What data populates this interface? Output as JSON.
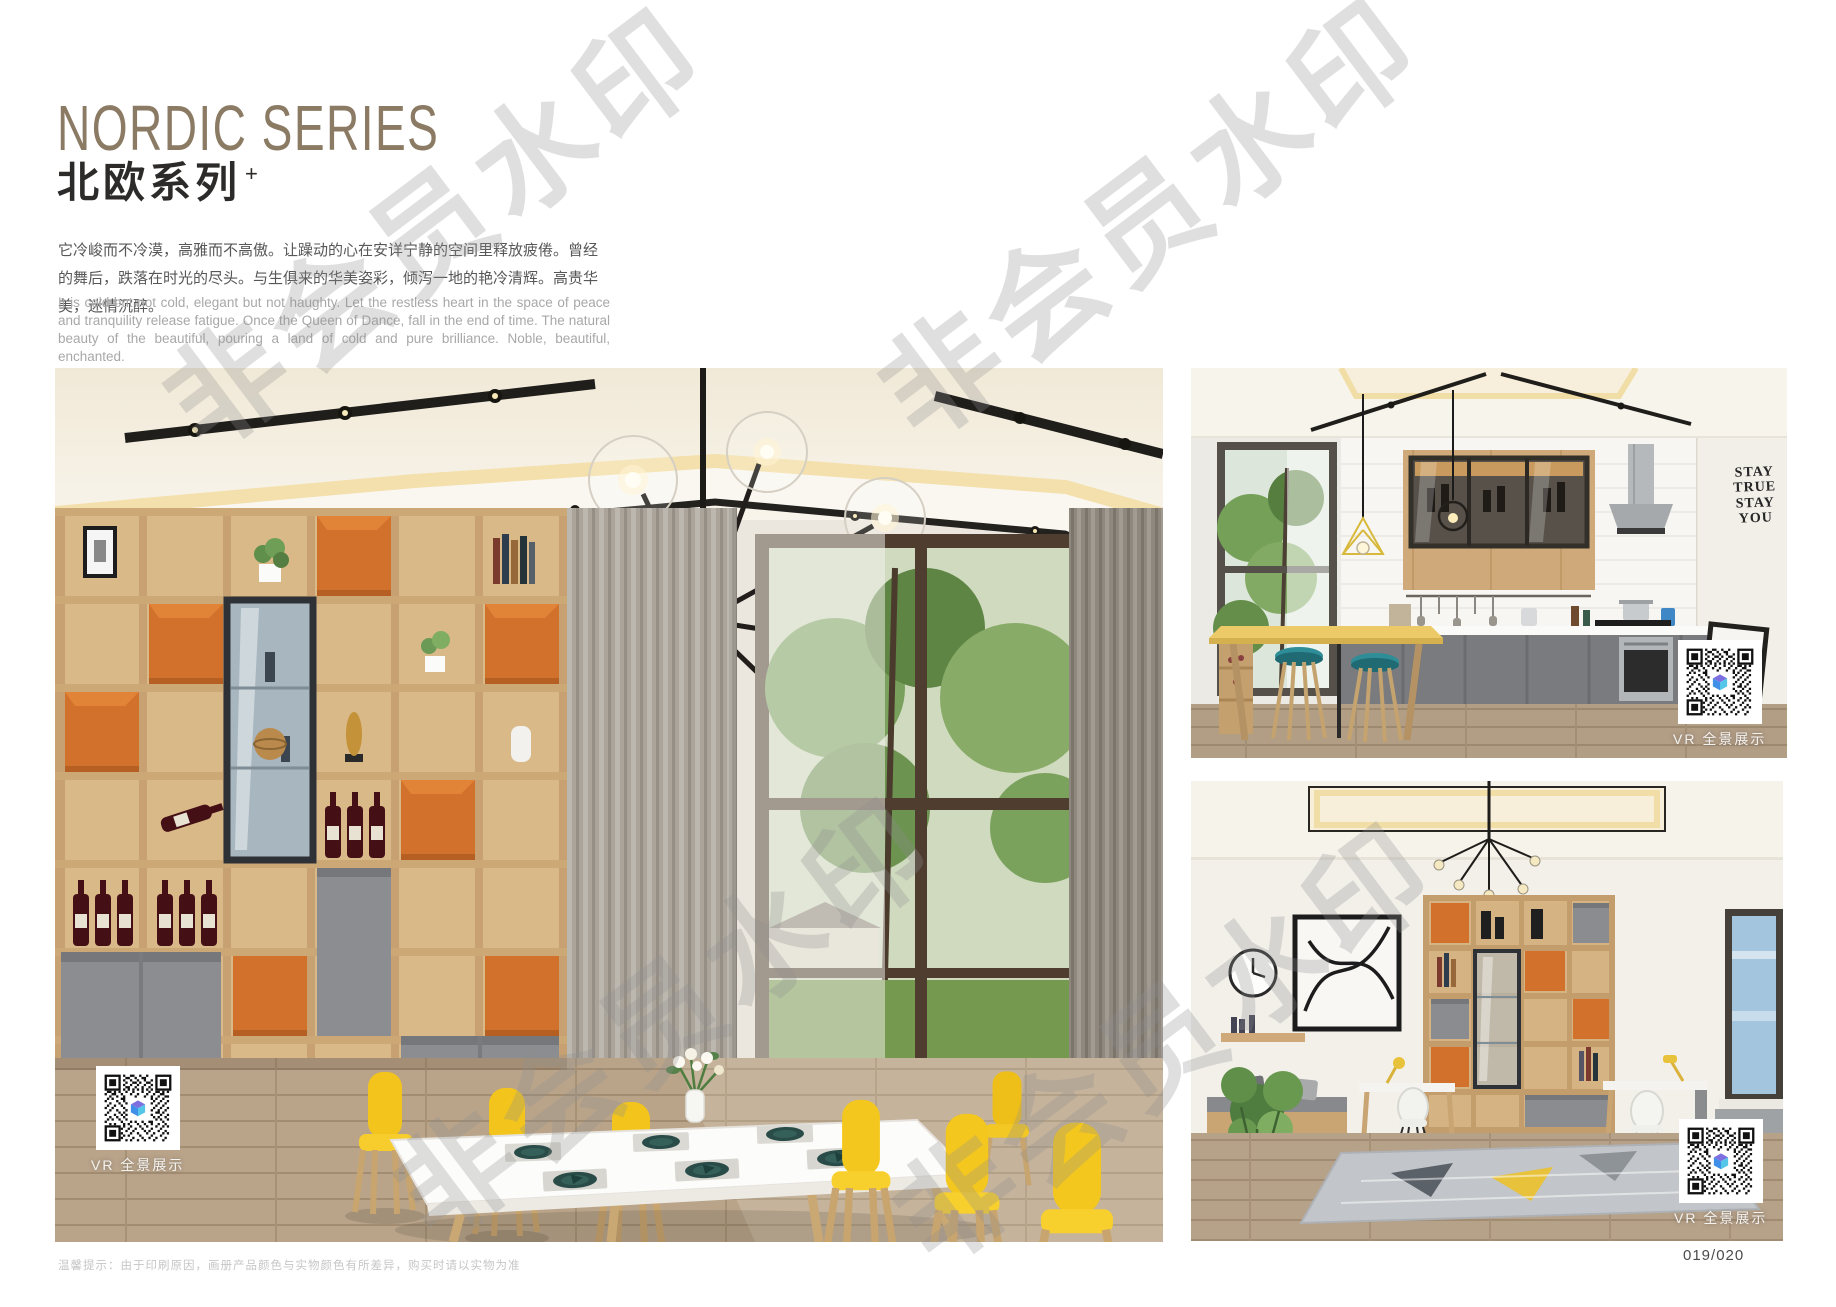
{
  "page": {
    "watermark_text": "非会员水印",
    "footer_tip": "温馨提示：由于印刷原因，画册产品颜色与实物颜色有所差异，购买时请以实物为准",
    "page_number": "019/020"
  },
  "header": {
    "title_en": "NORDIC SERIES",
    "title_zh": "北欧系列",
    "title_sup": "+",
    "desc_zh": "它冷峻而不冷漠，高雅而不高傲。让躁动的心在安详宁静的空间里释放疲倦。曾经的舞后，跌落在时光的尽头。与生俱来的华美姿彩，倾泻一地的艳冷清辉。高贵华美，迷情沉醉。",
    "desc_en": "It is cold but not cold, elegant but not haughty. Let the restless heart in the space of peace and tranquility release fatigue. Once the Queen of Dance, fall in the end of time. The natural beauty of the beautiful, pouring a land of cold and pure brilliance. Noble, beautiful, enchanted."
  },
  "photos": {
    "dining": {
      "vr_label": "VR 全景展示"
    },
    "kitchen": {
      "vr_label": "VR 全景展示",
      "wall_art": [
        "STAY",
        "TRUE",
        "STAY",
        "YOU"
      ]
    },
    "study": {
      "vr_label": "VR 全景展示"
    }
  },
  "colors": {
    "title_bronze": "#8c7b64",
    "accent_orange": "#d2712c",
    "chair_yellow": "#f2c41c",
    "stool_teal": "#2e8d97",
    "cabinet_gray": "#8b8d90",
    "wood": "#d9b988"
  }
}
